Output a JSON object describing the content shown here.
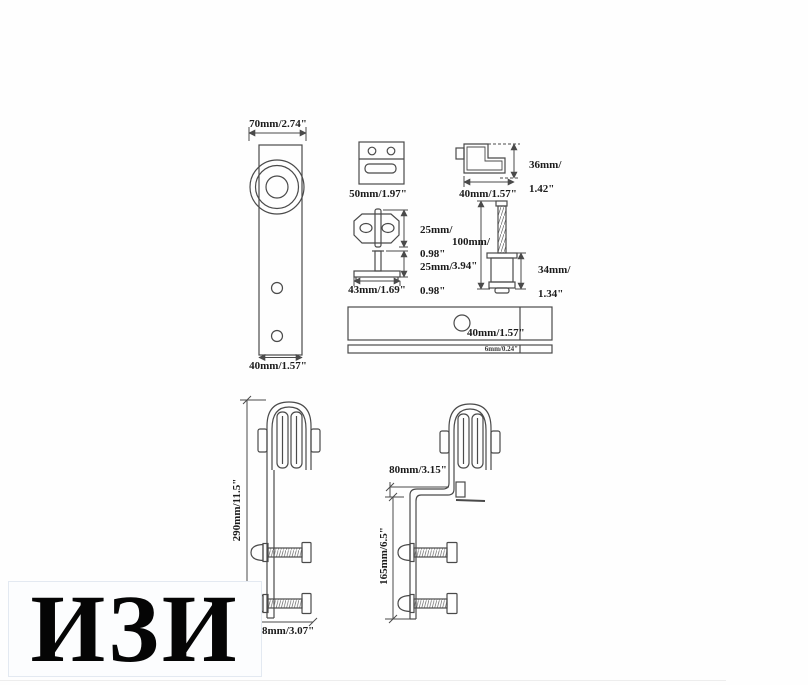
{
  "colors": {
    "line": "#4a4a4a",
    "label_text": "#1c1c1c",
    "watermark_bg": "#fcfdfe"
  },
  "watermark": {
    "text": "ИЗИ"
  },
  "diagrams": {
    "hanger_front": {
      "top_width": "70mm/2.74\"",
      "bottom_width": "40mm/1.57\""
    },
    "door_stop": {
      "width": "50mm/1.97\""
    },
    "l_bracket": {
      "height_line1": "36mm/",
      "height_line2": "1.42\"",
      "width": "40mm/1.57\""
    },
    "floor_guide": {
      "top_height_line1": "25mm/",
      "top_height_line2": "0.98\"",
      "side_height_line1": "25mm/",
      "side_height_line2": "0.98\"",
      "base_width": "43mm/1.69\""
    },
    "screw_spacer": {
      "screw_length_line1": "100mm/",
      "screw_length_line2": "3.94\"",
      "spacer_height_line1": "34mm/",
      "spacer_height_line2": "1.34\""
    },
    "rail": {
      "hole_spacing": "40mm/1.57\"",
      "thickness": "6mm/0.24\""
    },
    "hanger_side_left": {
      "height": "290mm/11.5\"",
      "width_visible": "8mm/3.07\""
    },
    "hanger_side_right": {
      "top_offset": "80mm/3.15\"",
      "strap_height": "165mm/6.5\""
    }
  }
}
